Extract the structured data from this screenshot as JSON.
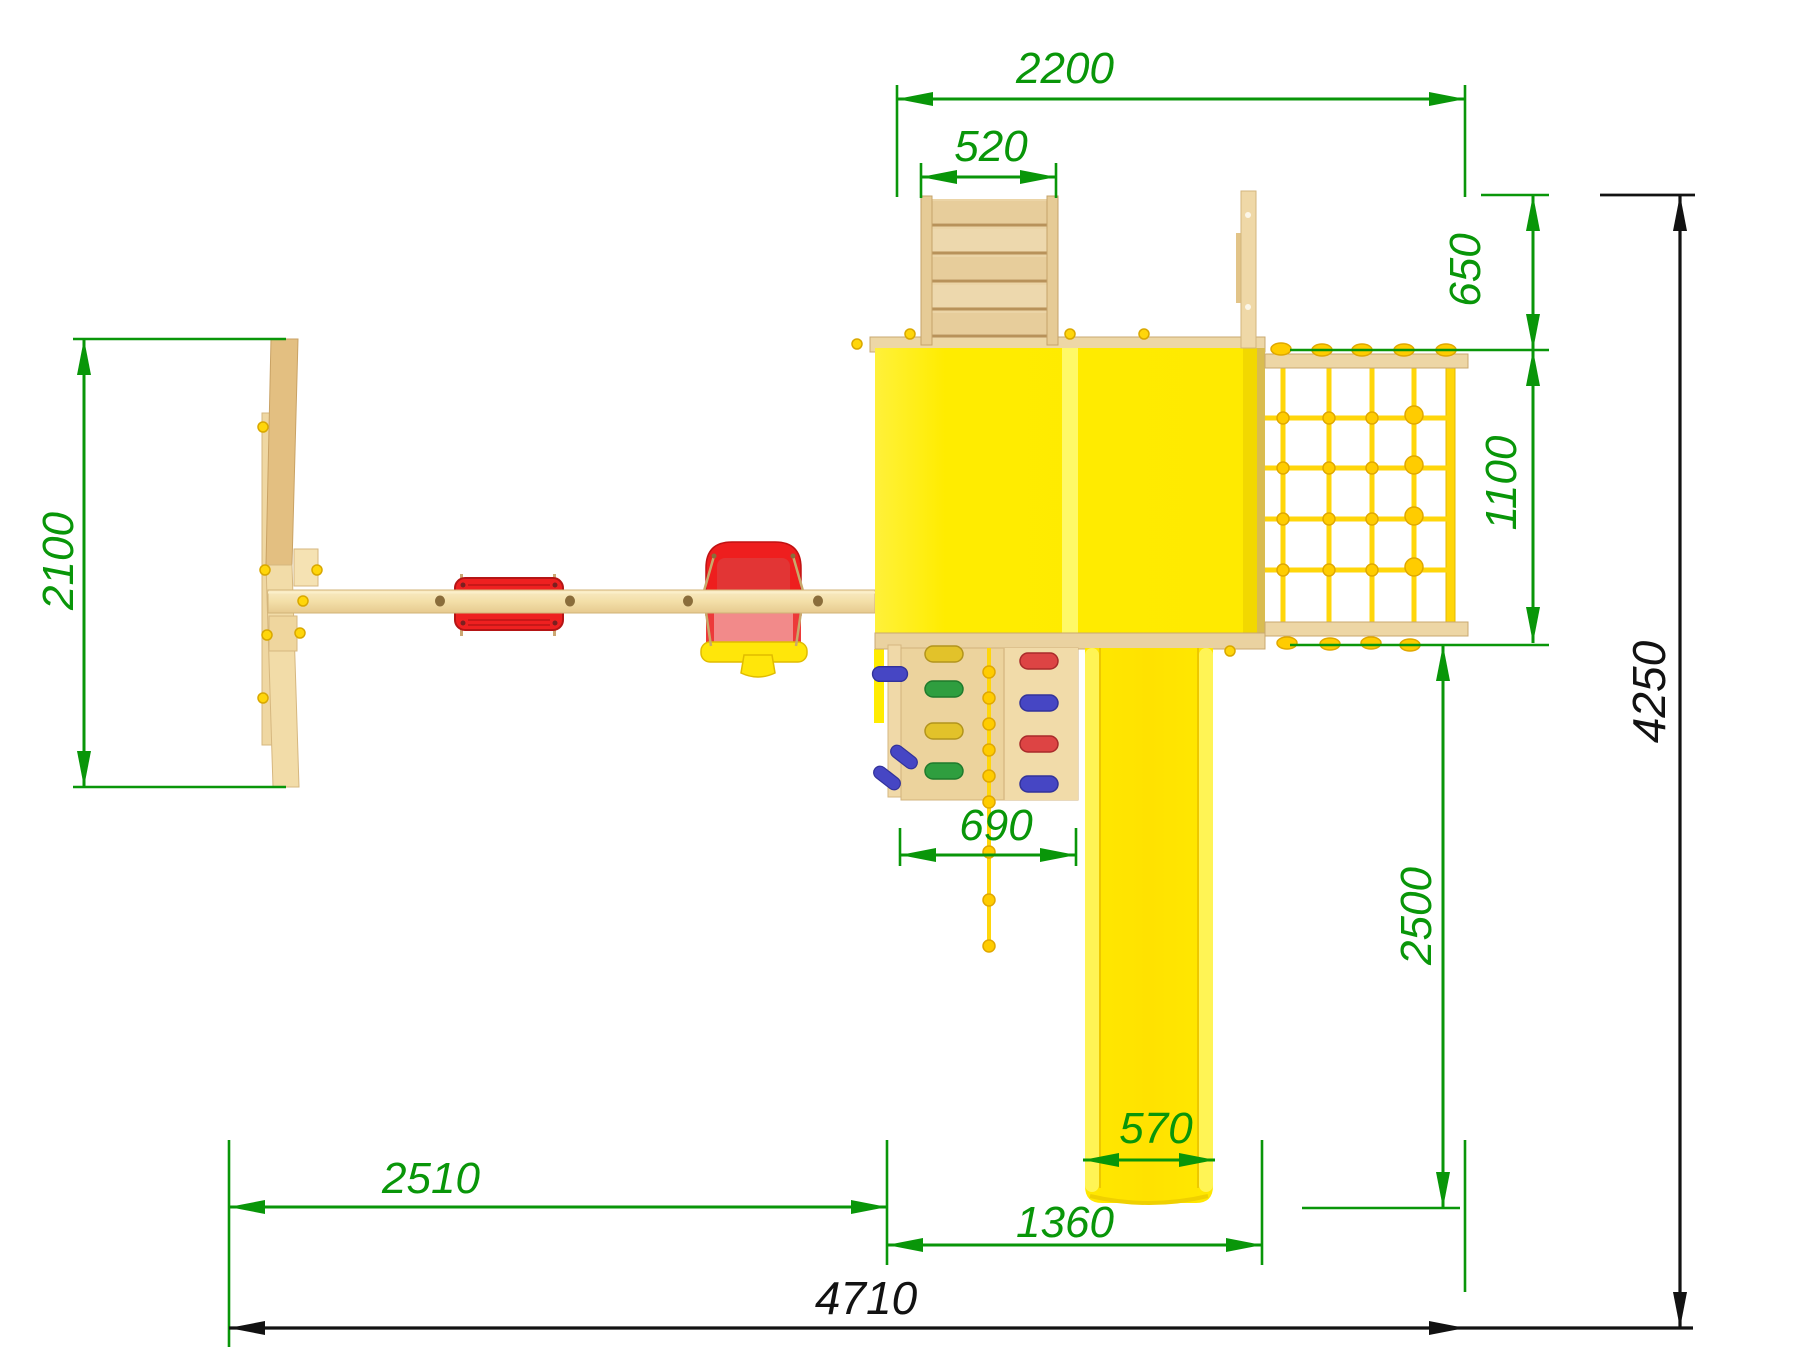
{
  "drawing": {
    "dimensions": {
      "tower_top_width": "2200",
      "ladder_width": "520",
      "balcony_depth": "650",
      "net_depth": "1100",
      "aframe_depth": "2100",
      "total_depth": "4250",
      "climbing_wall_width": "690",
      "slide_run": "2500",
      "slide_width": "570",
      "tower_section_width": "1360",
      "swing_section_width": "2510",
      "total_width": "4710"
    },
    "colors": {
      "dimension_green": "#099609",
      "dimension_black": "#121212",
      "wood_light": "#F2DCA8",
      "wood_mid": "#E8CF9C",
      "wood_dark": "#DDBA7E",
      "roof_yellow": "#FFEC00",
      "roof_ridge": "#FFF966",
      "rope_yellow": "#FFD60A",
      "seat_red": "#EE1E1E",
      "seat_pink": "#F28A8A",
      "hold_red": "#DD4444",
      "hold_blue": "#4646C4",
      "hold_green": "#2F9E3F",
      "hold_yellow": "#E2C22A"
    }
  }
}
